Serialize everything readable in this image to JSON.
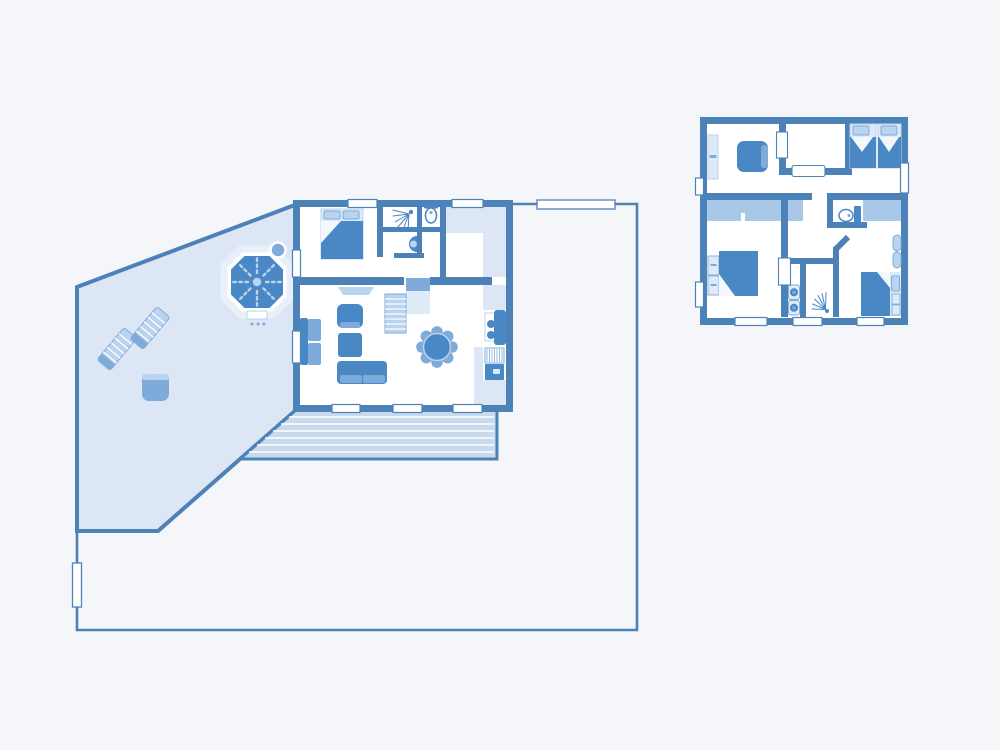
{
  "canvas": {
    "width": 1000,
    "height": 750
  },
  "colors": {
    "background": "#f5f6f9",
    "wall": "#4d82b8",
    "floor": "#ffffff",
    "terrace_tint": "#dce6f5",
    "deck": "#c9daee",
    "deck_line": "#ffffff",
    "ceiling_band": "#a9c7e7",
    "furniture_dark": "#4987c5",
    "furniture_medium": "#7eabda",
    "furniture_light": "#bad3ee",
    "furniture_pale": "#ddeaf8",
    "window": "#ffffff",
    "fold": "#f3f8fd"
  },
  "plans": [
    {
      "name": "ground-floor-plan",
      "outdoor": [
        "property-boundary",
        "garden-gate-top",
        "garden-gate-left",
        "terrace",
        "hot-tub",
        "hot-tub-steps",
        "sun-lounger",
        "sun-lounger",
        "garden-stool",
        "wood-deck"
      ],
      "rooms": [
        "double-bedroom",
        "shower-room",
        "toilet-room",
        "hallway",
        "living-room",
        "kitchen"
      ],
      "furniture": [
        "double-bed",
        "shower-icon",
        "toilet-icon",
        "washbasin-icon",
        "sideboard",
        "sofa",
        "armchair",
        "coffee-table",
        "two-seat-sofa",
        "staircase",
        "dining-table",
        "stove",
        "fridge",
        "drainer",
        "kitchen-sink"
      ]
    },
    {
      "name": "upper-floor-plan",
      "rooms": [
        "study",
        "stair-landing",
        "twin-bedroom",
        "double-bedroom",
        "hallway",
        "toilet-room",
        "laundry-closet",
        "shower-room",
        "single-bedroom"
      ],
      "furniture": [
        "wall-shelf",
        "armchair",
        "stairwell-opening",
        "twin-bed",
        "twin-bed",
        "toilet-icon",
        "double-bed",
        "dresser",
        "washing-machine",
        "dryer",
        "shower-icon",
        "wardrobe",
        "single-bed",
        "nightstand"
      ]
    }
  ]
}
